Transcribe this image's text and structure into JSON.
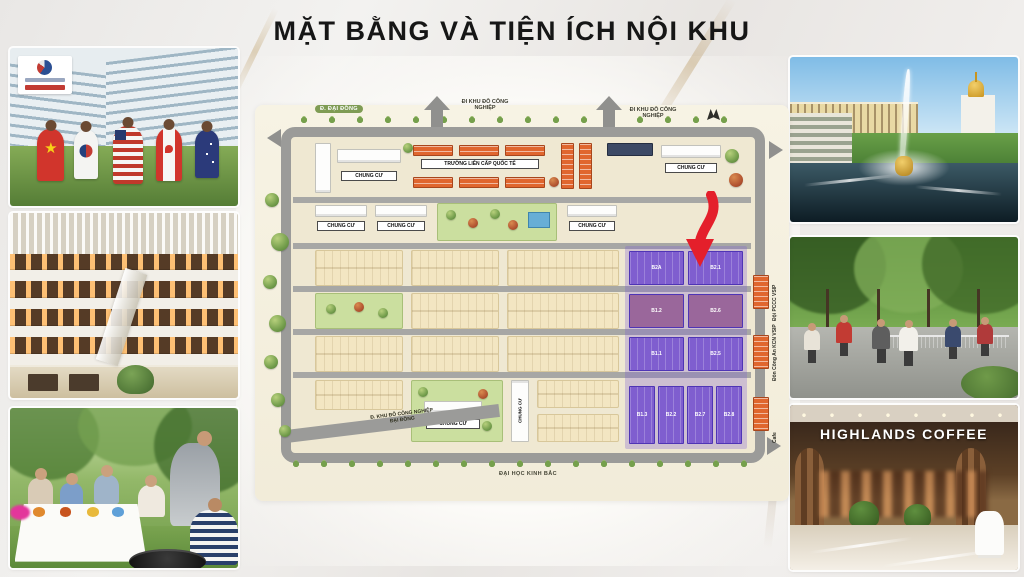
{
  "slide": {
    "title": "MẶT BẰNG VÀ TIỆN ÍCH NỘI KHU"
  },
  "map": {
    "labels": {
      "road_dai_dong": "Đ. ĐẠI ĐỒNG",
      "exit_industrial_left": "ĐI KHU ĐÔ CÔNG NGHIỆP",
      "exit_industrial_right": "ĐI KHU ĐÔ CÔNG NGHIỆP",
      "road_diag_1": "Đ. KHU ĐÔ CÔNG NGHIỆP",
      "road_diag_2": "ĐẠI ĐỒNG",
      "road_university": "ĐẠI HỌC KINH BẮC",
      "apartment": "CHUNG CƯ",
      "school": "TRƯỜNG LIÊN CẤP QUỐC TẾ"
    },
    "amenities": [
      "Đội PCCC VSIP",
      "Đồn Công An KCN VSIP",
      "Cafe"
    ],
    "blocks": {
      "r1c1": "B2A",
      "r1c2": "B2.1",
      "r2c1": "B1.2",
      "r2c2": "B2.6",
      "r3c1": "B1.1",
      "r3c2": "B2.5",
      "b1": "B1.3",
      "b2": "B2.2",
      "b3": "B2.7",
      "b4": "B2.8"
    },
    "colors": {
      "highlight": "#7a5ad0",
      "road": "#9b9b99",
      "block": "#f2e3c2",
      "school_building": "#e0662e",
      "arrow": "#e41f2b",
      "pool": "#67aed6"
    }
  },
  "photos": {
    "school": {
      "name": "international-school-flags"
    },
    "mall": {
      "name": "shopping-mall-atrium"
    },
    "bbq": {
      "name": "family-bbq-picnic"
    },
    "palace": {
      "name": "palace-fountain-garden"
    },
    "park": {
      "name": "park-badminton"
    },
    "coffee": {
      "name": "highlands-coffee-shopfront",
      "sign": "HIGHLANDS COFFEE"
    }
  }
}
